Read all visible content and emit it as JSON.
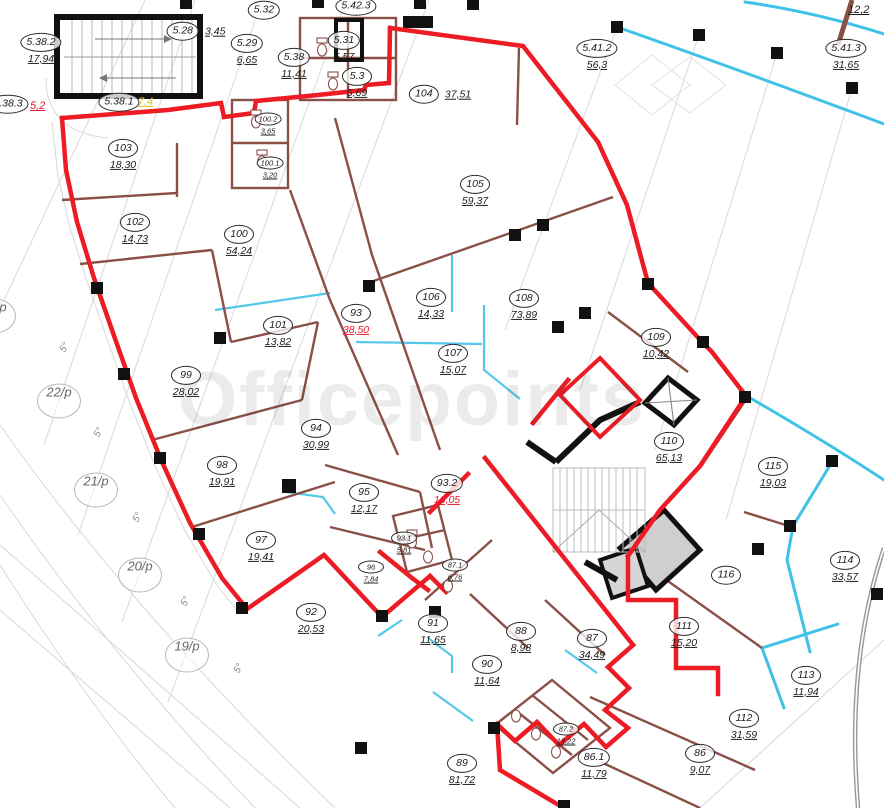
{
  "watermark": "Officepoints",
  "colors": {
    "boundary_red": "#ec1b24",
    "area_text_red": "#e8192c",
    "partition_brown": "#8a4f47",
    "glazing_cyan": "#3fc1e8",
    "grid_gray": "#d8d8d8",
    "highlight_yellow": "#e8c020"
  },
  "grid": {
    "radial": [
      "23/p",
      "22/p",
      "21/p",
      "20/p",
      "19/p"
    ],
    "angle": "5°"
  },
  "annotations": [
    {
      "text": "5,2",
      "color": "red"
    },
    {
      "text": "7,4",
      "color": "yellow"
    },
    {
      "text": "12,2",
      "color": "black"
    }
  ],
  "rooms": [
    {
      "id": "5.38.2",
      "area": "17,94"
    },
    {
      "id": "5.28",
      "area": "3,45"
    },
    {
      "id": "5.29",
      "area": "6,65"
    },
    {
      "id": "5.32",
      "area": ""
    },
    {
      "id": "5.42.3",
      "area": ""
    },
    {
      "id": "5.38",
      "area": "11,41"
    },
    {
      "id": "5.31",
      "area": "5,57"
    },
    {
      "id": "5.3",
      "area": "5,69"
    },
    {
      "id": "5.38.1",
      "area": ""
    },
    {
      "id": "5.38.3",
      "area": ""
    },
    {
      "id": "104",
      "area": "37,51"
    },
    {
      "id": "5.41.2",
      "area": "56,3"
    },
    {
      "id": "5.41.3",
      "area": "31,65"
    },
    {
      "id": "103",
      "area": "18,30"
    },
    {
      "id": "100.2",
      "area": "3,65"
    },
    {
      "id": "100.1",
      "area": "3,20"
    },
    {
      "id": "102",
      "area": "14,73"
    },
    {
      "id": "100",
      "area": "54,24"
    },
    {
      "id": "105",
      "area": "59,37"
    },
    {
      "id": "106",
      "area": "14,33"
    },
    {
      "id": "93",
      "area": "38,50"
    },
    {
      "id": "107",
      "area": "15,07"
    },
    {
      "id": "108",
      "area": "73,89"
    },
    {
      "id": "109",
      "area": "10,42"
    },
    {
      "id": "101",
      "area": "13,82"
    },
    {
      "id": "99",
      "area": "28,02"
    },
    {
      "id": "94",
      "area": "30,99"
    },
    {
      "id": "110",
      "area": "65,13"
    },
    {
      "id": "98",
      "area": "19,91"
    },
    {
      "id": "115",
      "area": "19,03"
    },
    {
      "id": "95",
      "area": "12,17"
    },
    {
      "id": "93.2",
      "area": "16,05"
    },
    {
      "id": "97",
      "area": "19,41"
    },
    {
      "id": "93.1",
      "area": "5,81"
    },
    {
      "id": "114",
      "area": "33,57"
    },
    {
      "id": "96",
      "area": "7,84"
    },
    {
      "id": "87.1",
      "area": "6,76"
    },
    {
      "id": "116",
      "area": ""
    },
    {
      "id": "92",
      "area": "20,53"
    },
    {
      "id": "91",
      "area": "11,65"
    },
    {
      "id": "111",
      "area": "15,20"
    },
    {
      "id": "88",
      "area": "8,98"
    },
    {
      "id": "87",
      "area": "34,49"
    },
    {
      "id": "90",
      "area": "11,64"
    },
    {
      "id": "113",
      "area": "11,94"
    },
    {
      "id": "87.2",
      "area": "13,22"
    },
    {
      "id": "112",
      "area": "31,59"
    },
    {
      "id": "89",
      "area": "81,72"
    },
    {
      "id": "86.1",
      "area": "11,79"
    },
    {
      "id": "86",
      "area": "9,07"
    }
  ]
}
